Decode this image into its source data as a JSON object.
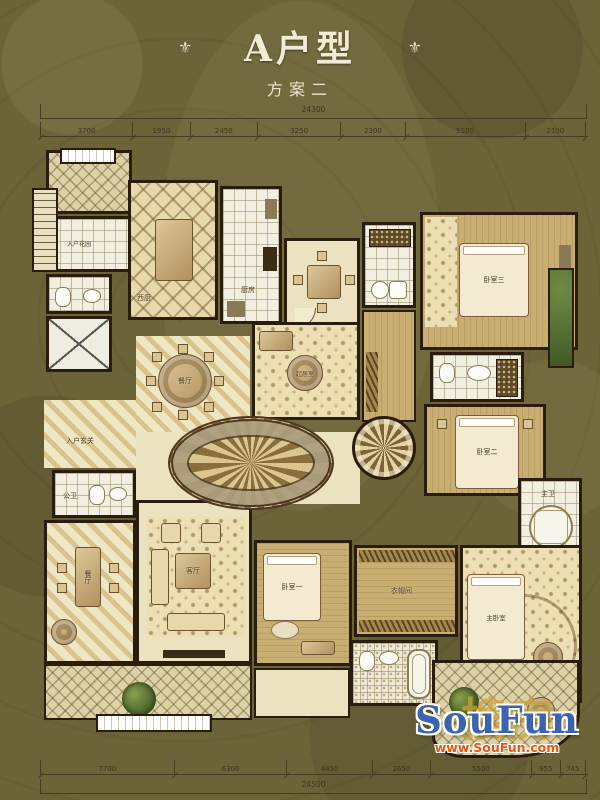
{
  "title": {
    "main": "A户型",
    "subtitle": "方案二",
    "ornament": "⚜"
  },
  "dimensions": {
    "top_overall": "24300",
    "top": [
      "3700",
      "1950",
      "2450",
      "3250",
      "2300",
      "5100",
      "2100"
    ],
    "bottom": [
      "7700",
      "6300",
      "4450",
      "2650",
      "5500",
      "955",
      "745"
    ],
    "bottom_overall": "24500"
  },
  "rooms": {
    "entry_garden": {
      "label": "入户花园"
    },
    "west_kitchen": {
      "label": "西厨"
    },
    "kitchen": {
      "label": "厨房"
    },
    "dining_round": {
      "label": "餐厅"
    },
    "family_room": {
      "label": "起居室"
    },
    "foyer": {
      "label": "入户玄关"
    },
    "powder_room": {
      "label": "公卫"
    },
    "dining_long": {
      "label": "餐厅"
    },
    "living_room": {
      "label": "客厅"
    },
    "bedroom1": {
      "label": "卧室一"
    },
    "bedroom2": {
      "label": "卧室二"
    },
    "bedroom3": {
      "label": "卧室三"
    },
    "master_bedroom": {
      "label": "主卧室"
    },
    "closet": {
      "label": "衣帽间"
    },
    "master_bath": {
      "label": "主卫"
    }
  },
  "watermark": {
    "cn": "搜房",
    "en": "SouFun",
    "url": "www.SouFun.com"
  },
  "colors": {
    "background": "#6c6338",
    "soufun_blue": "#3b63ae",
    "soufun_orange": "#e8570e",
    "soufun_gold": "#c9a43c"
  }
}
